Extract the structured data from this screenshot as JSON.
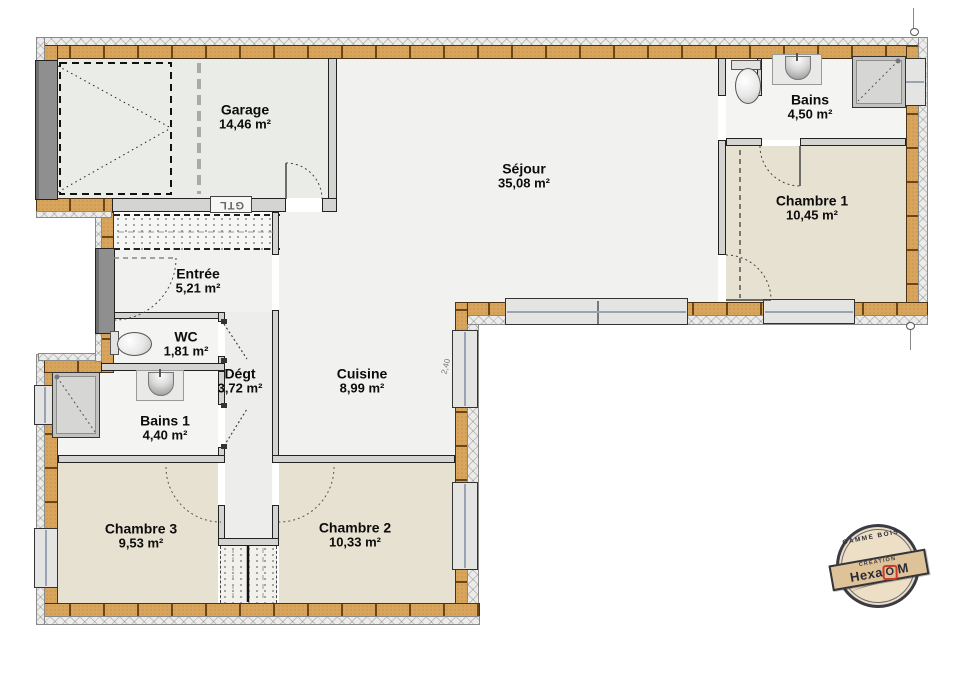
{
  "rooms": [
    {
      "id": "garage",
      "name": "Garage",
      "area": "14,46 m²"
    },
    {
      "id": "sejour",
      "name": "Séjour",
      "area": "35,08 m²"
    },
    {
      "id": "bains",
      "name": "Bains",
      "area": "4,50 m²"
    },
    {
      "id": "chambre1",
      "name": "Chambre 1",
      "area": "10,45 m²"
    },
    {
      "id": "entree",
      "name": "Entrée",
      "area": "5,21 m²"
    },
    {
      "id": "wc",
      "name": "WC",
      "area": "1,81 m²"
    },
    {
      "id": "degt",
      "name": "Dégt",
      "area": "3,72 m²"
    },
    {
      "id": "cuisine",
      "name": "Cuisine",
      "area": "8,99 m²"
    },
    {
      "id": "bains1",
      "name": "Bains 1",
      "area": "4,40 m²"
    },
    {
      "id": "chambre3",
      "name": "Chambre 3",
      "area": "9,53 m²"
    },
    {
      "id": "chambre2",
      "name": "Chambre 2",
      "area": "10,33 m²"
    }
  ],
  "annotations": {
    "gtl": "GTL",
    "dim_cuisine": "2,40"
  },
  "stamp": {
    "arc_top": "GAMME BOIS",
    "creation": "CRÉATION",
    "brand_pre": "Hexa",
    "brand_o": "O",
    "brand_post": "M"
  },
  "colors": {
    "wall_wood": "#d9a45b",
    "floor_bedroom": "#e7e1d1",
    "floor_living": "#f1f1ef",
    "floor_garage": "#eaece8",
    "stamp_red": "#cf3a28"
  }
}
